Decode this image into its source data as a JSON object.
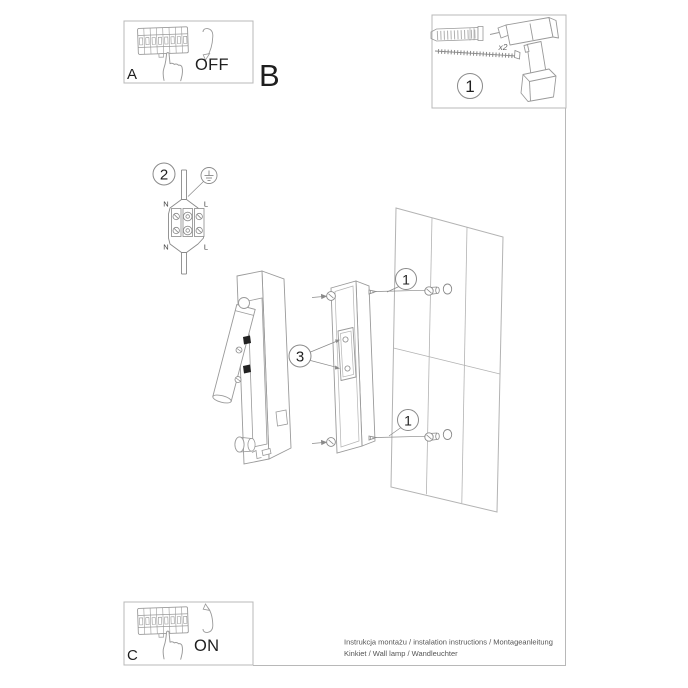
{
  "colors": {
    "ink": "#1f1f1f",
    "line": "#9a9a9a",
    "frame": "#b8b8b8"
  },
  "steps": {
    "a": {
      "label": "A",
      "state": "OFF"
    },
    "b": {
      "label": "B"
    },
    "c": {
      "label": "C",
      "state": "ON"
    }
  },
  "parts": {
    "callout": "1",
    "quantity": "x2"
  },
  "wiring": {
    "callout": "2",
    "n_top": "N",
    "l_top": "L",
    "n_bottom": "N",
    "l_bottom": "L"
  },
  "mounting": {
    "callout": "3",
    "screw_callout_top": "1",
    "screw_callout_bottom": "1"
  },
  "footer": {
    "line1": "Instrukcja montażu / instalation instructions / Montageanleitung",
    "line2": "Kinkiet / Wall lamp / Wandleuchter"
  }
}
